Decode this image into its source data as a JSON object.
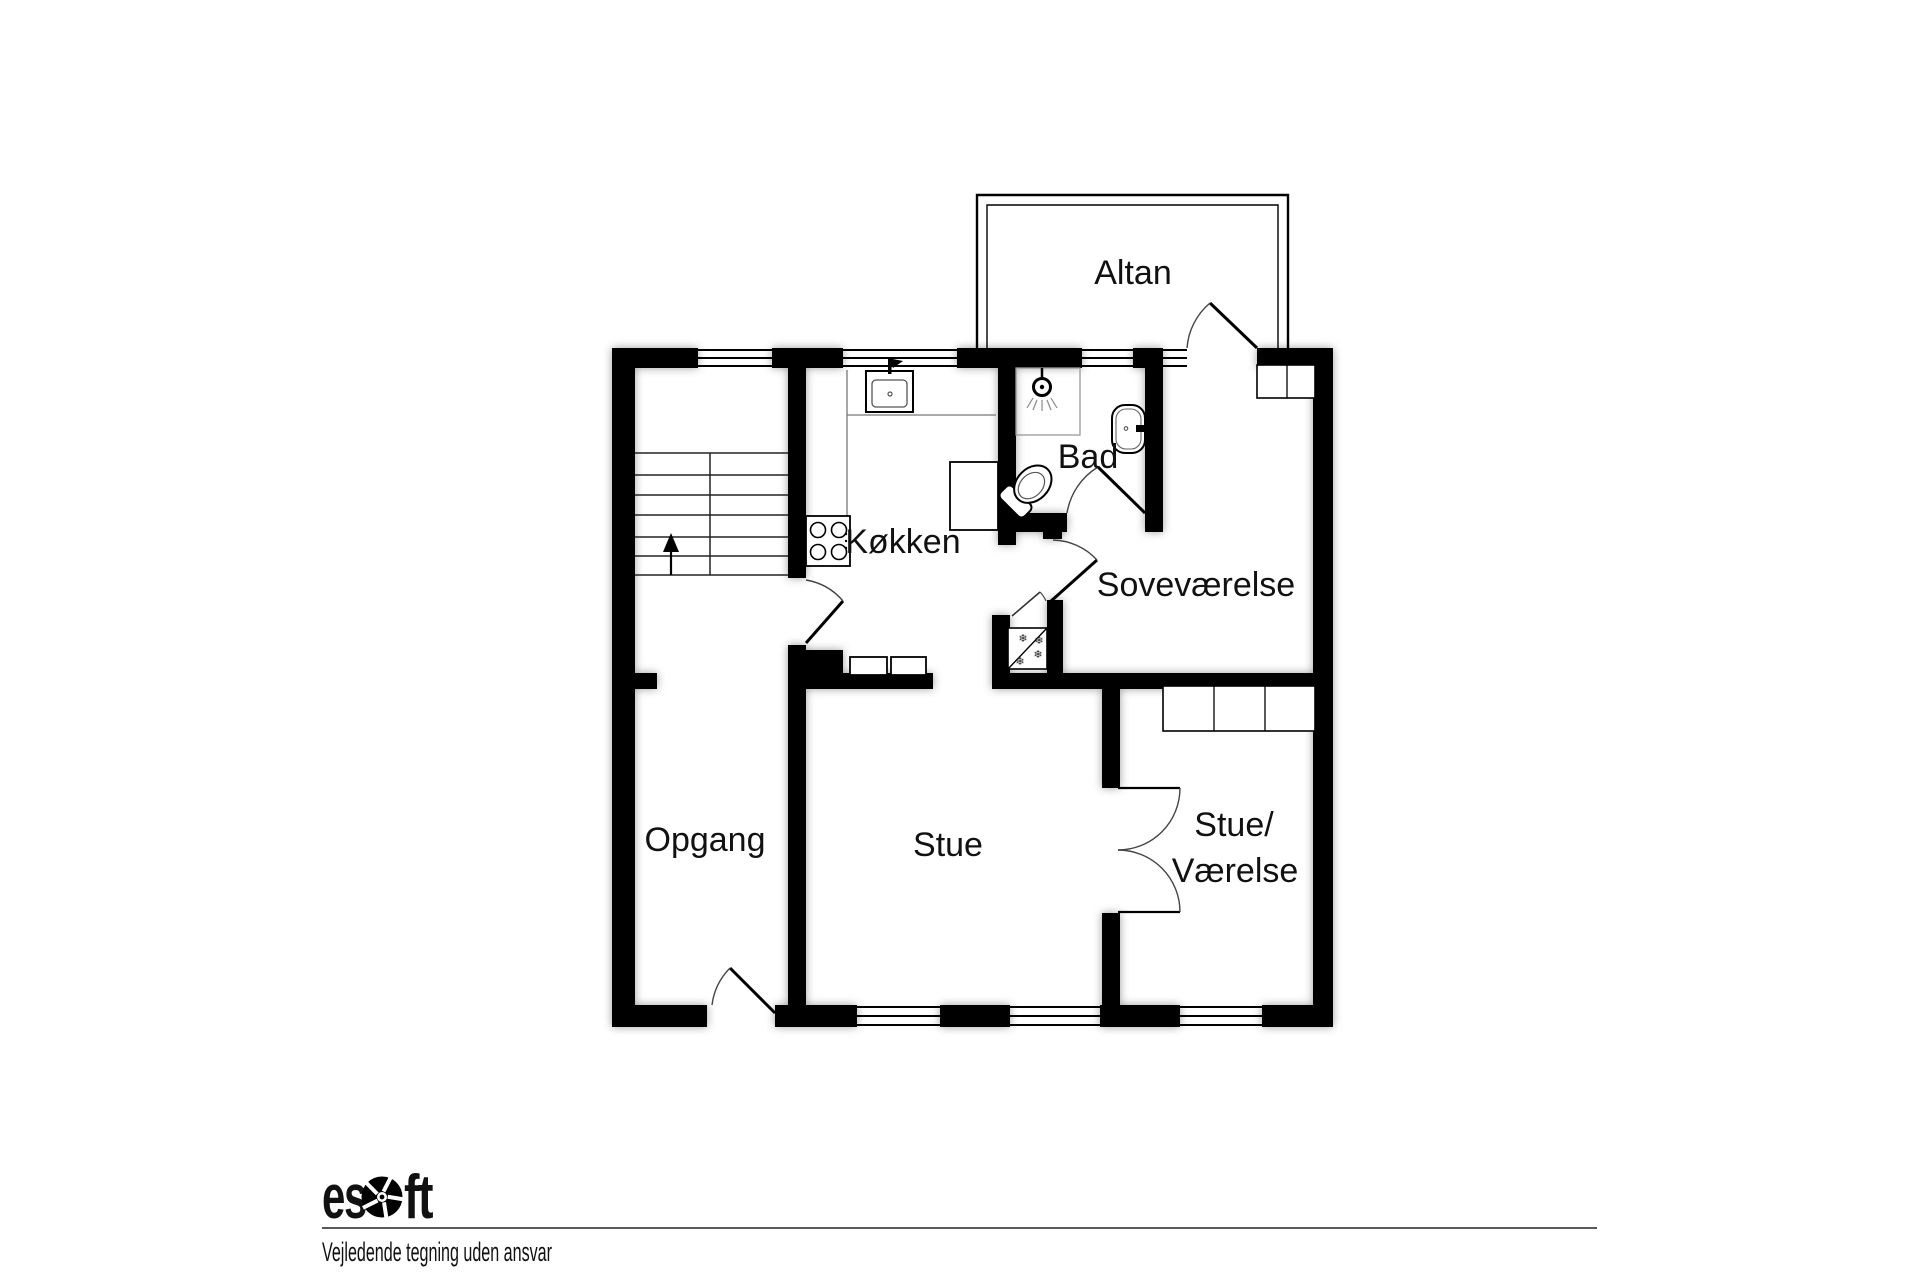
{
  "colors": {
    "background": "#ffffff",
    "wall": "#000000",
    "label": "#111111",
    "thin_line": "#555555"
  },
  "rooms": [
    {
      "id": "altan",
      "label": "Altan"
    },
    {
      "id": "bad",
      "label": "Bad"
    },
    {
      "id": "kokken",
      "label": "Køkken"
    },
    {
      "id": "sovevaerelse",
      "label": "Soveværelse"
    },
    {
      "id": "opgang",
      "label": "Opgang"
    },
    {
      "id": "stue",
      "label": "Stue"
    },
    {
      "id": "stue_vaerelse",
      "label_line1": "Stue/",
      "label_line2": "Værelse"
    }
  ],
  "symbols": {
    "snowflake": "❄"
  },
  "icons": {
    "shower": "shower-head-icon",
    "toilet": "toilet-icon",
    "washbasin": "washbasin-icon",
    "kitchen_sink": "kitchen-sink-icon",
    "stove": "stove-burners-icon",
    "refrigerator": "refrigerator-freezer-icon",
    "stairs": "stairs-up-icon"
  },
  "footer": {
    "logo": "esoft",
    "logo_part1": "es",
    "logo_part2": "ft",
    "disclaimer": "Vejledende tegning uden ansvar"
  }
}
